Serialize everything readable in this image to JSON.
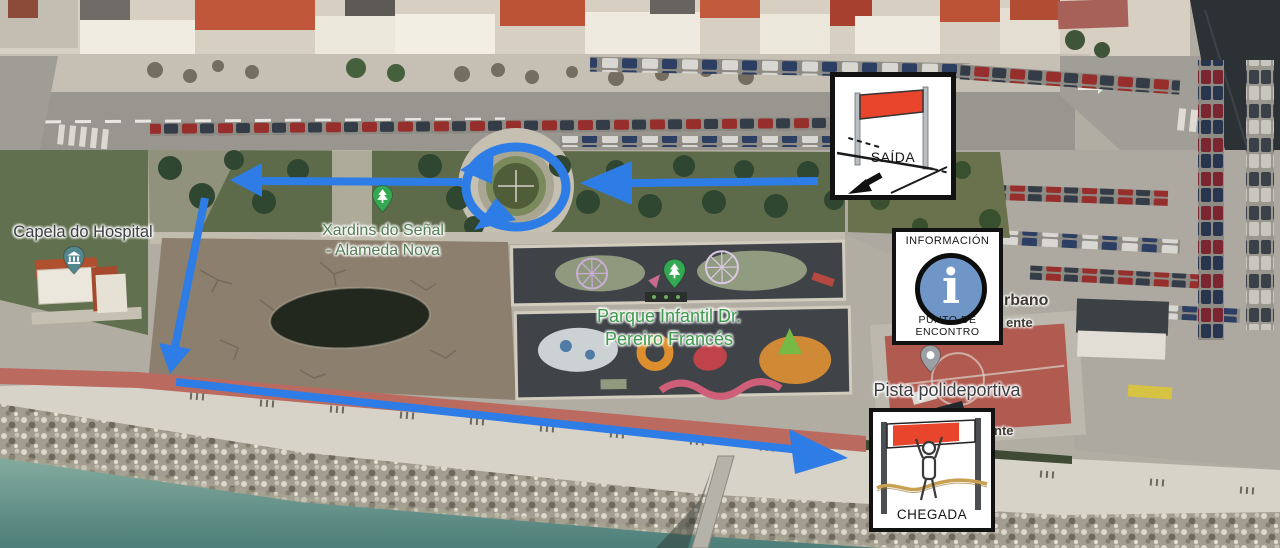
{
  "colors": {
    "arrow": "#2e7de6",
    "sign_border": "#121212",
    "sign_red": "#e8452c",
    "info_circle": "#7096c8",
    "pin_park": "#34a853",
    "pin_poi": "#53878f",
    "pin_generic": "#9aa0a6",
    "label_park": "#3f9a4e",
    "label_park_dark": "#557d57",
    "label_dark": "#3a3e42",
    "sea": "#5d8d85"
  },
  "labels": {
    "capela": "Capela do Hospital",
    "xardins_line1": "Xardins do Señal",
    "xardins_line2": "- Alameda Nova",
    "parque_line1": "Parque Infantil Dr.",
    "parque_line2": "Pereiro Francés",
    "pista": "Pista polideportiva",
    "fragment_urbano": "rbano",
    "fragment_ente": "ente",
    "fragment_nte": "nte"
  },
  "signs": {
    "saida": {
      "label": "SAÍDA"
    },
    "info": {
      "top": "INFORMACIÓN",
      "bottom": "PUNTO DE ENCONTRO"
    },
    "chegada": {
      "label": "CHEGADA"
    }
  }
}
